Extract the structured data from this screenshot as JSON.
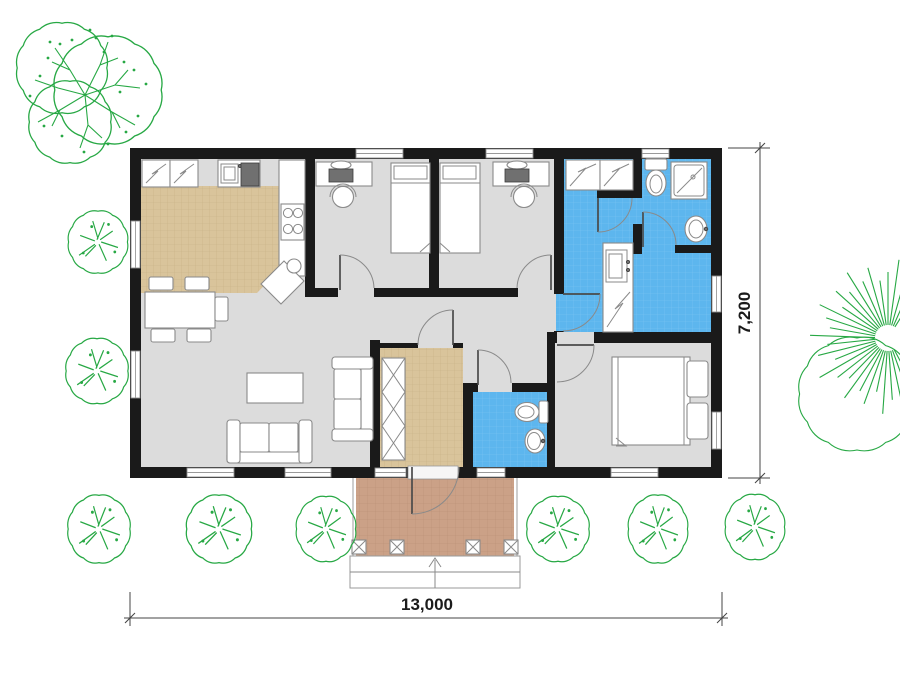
{
  "plan": {
    "width_label": "13,000",
    "height_label": "7,200"
  },
  "colors": {
    "paper": "#ffffff",
    "wall": "#1a1a1a",
    "floor_gray": "#dcdcdc",
    "floor_tan": "#d9c49b",
    "floor_blue": "#5db6ee",
    "floor_porch": "#cba187",
    "vegetation": "#27a844",
    "furniture_stroke": "#8a8a8a",
    "appliance_dark": "#707070"
  },
  "rooms": [
    {
      "name": "kitchen-dining"
    },
    {
      "name": "bedroom-left"
    },
    {
      "name": "bedroom-middle"
    },
    {
      "name": "laundry-room"
    },
    {
      "name": "bathroom"
    },
    {
      "name": "hallway"
    },
    {
      "name": "living-room"
    },
    {
      "name": "entry-hall"
    },
    {
      "name": "wc"
    },
    {
      "name": "bedroom-master"
    },
    {
      "name": "porch"
    }
  ],
  "decor": {
    "palm": {
      "cx": 888,
      "cy": 338,
      "inner": 13,
      "angle_start": 58,
      "step": 8,
      "radii": [
        60,
        74,
        56,
        79,
        66,
        58,
        73,
        62,
        77,
        60,
        70,
        55,
        76,
        65,
        59,
        78,
        61,
        72,
        57,
        79,
        64,
        56,
        74,
        60,
        70,
        55,
        76,
        62,
        68,
        58,
        72
      ]
    },
    "bushes": [
      {
        "cx": 98,
        "cy": 242,
        "sx": 1.05,
        "sy": 1.1
      },
      {
        "cx": 97,
        "cy": 371,
        "sx": 1.1,
        "sy": 1.15
      },
      {
        "cx": 99,
        "cy": 529,
        "sx": 1.1,
        "sy": 1.2
      },
      {
        "cx": 219,
        "cy": 529,
        "sx": 1.15,
        "sy": 1.2
      },
      {
        "cx": 326,
        "cy": 529,
        "sx": 1.05,
        "sy": 1.15
      },
      {
        "cx": 558,
        "cy": 529,
        "sx": 1.1,
        "sy": 1.15
      },
      {
        "cx": 658,
        "cy": 529,
        "sx": 1.05,
        "sy": 1.2
      },
      {
        "cx": 755,
        "cy": 527,
        "sx": 1.05,
        "sy": 1.15
      }
    ]
  }
}
